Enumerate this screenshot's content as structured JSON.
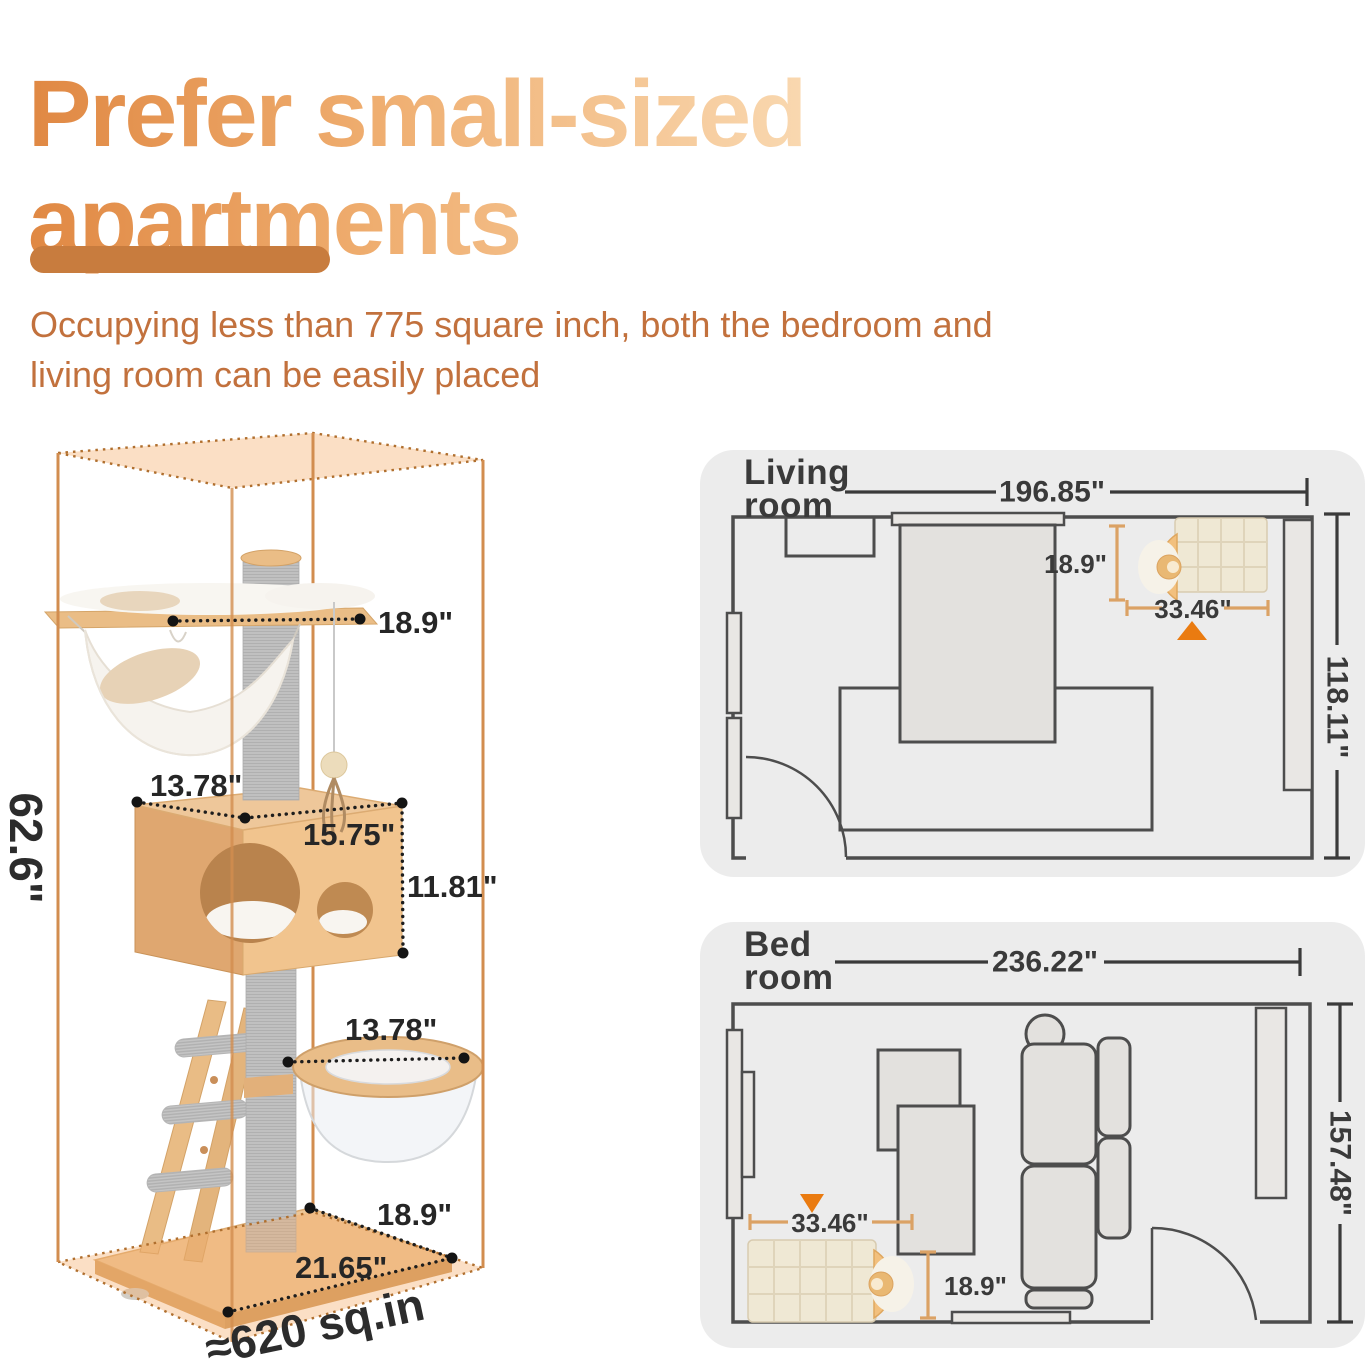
{
  "title": {
    "line1": "Prefer small-sized",
    "line2": "apartments"
  },
  "subtitle": {
    "line1": "Occupying less than 775 square inch, both the bedroom and",
    "line2": "living room can be easily placed"
  },
  "colors": {
    "title_gradient_start": "#e08843",
    "title_gradient_end": "#f9d8b0",
    "divider": "#c87c3e",
    "subtitle_text": "#c2713d",
    "card_background": "#ececec",
    "plan_line": "#4d4d4d",
    "dimension_text": "#3a3a3a",
    "bracket_orange": "#dba265",
    "placement_triangle": "#ea7b10",
    "box_wireframe": "#d28d4f"
  },
  "cat_tree": {
    "height_label": "62.6\"",
    "top_width_label": "18.9\"",
    "condo_depth_label": "13.78\"",
    "condo_width_label": "15.75\"",
    "condo_height_label": "11.81\"",
    "capsule_width_label": "13.78\"",
    "base_depth_label": "18.9\"",
    "base_width_label": "21.65\"",
    "footprint_label": "≈620 sq.in"
  },
  "living_room": {
    "title_line1": "Living",
    "title_line2": "room",
    "width_label": "196.85\"",
    "depth_label": "118.11\"",
    "tree_depth_label": "18.9\"",
    "tree_width_label": "33.46\""
  },
  "bed_room": {
    "title_line1": "Bed",
    "title_line2": "room",
    "width_label": "236.22\"",
    "depth_label": "157.48\"",
    "tree_width_label": "33.46\"",
    "tree_depth_label": "18.9\""
  }
}
